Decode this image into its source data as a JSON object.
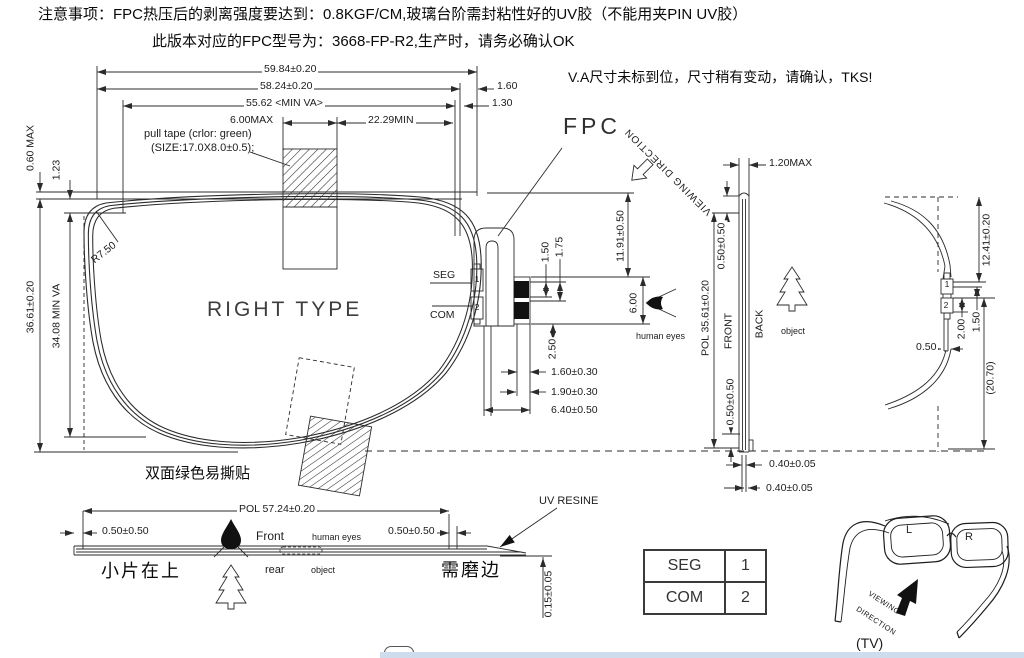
{
  "colors": {
    "line": "#2b2b2b",
    "taskbar_strip": "#cfdceb",
    "pad_fill": "#111111"
  },
  "notes": {
    "line1": "注意事项：FPC热压后的剥离强度要达到：0.8KGF/CM,玻璃台阶需封粘性好的UV胶（不能用夹PIN UV胶）",
    "line2": "此版本对应的FPC型号为：3668-FP-R2,生产时，请务必确认OK",
    "va_note": "V.A尺寸未标到位，尺寸稍有变动，请确认，TKS!"
  },
  "front_view": {
    "title": "RIGHT TYPE",
    "dim_width_outer": "59.84±0.20",
    "dim_width_pol": "58.24±0.20",
    "dim_right_1": "1.60",
    "dim_width_va": "55.62 <MIN VA>",
    "dim_right_2": "1.30",
    "dim_tape_offset": "6.00MAX",
    "dim_tape_to_edge": "22.29MIN",
    "dim_height_left_1": "0.60 MAX",
    "dim_height_left_2": "1.23",
    "dim_height_outer": "36.61±0.20",
    "dim_height_va": "34.08 MIN VA",
    "corner_radius": "R7.50",
    "pull_tape_note1": "pull tape (crlor: green)",
    "pull_tape_note2": "(SIZE:17.0X8.0±0.5);",
    "seg_label": "SEG",
    "com_label": "COM",
    "pad1": "1",
    "pad2": "2",
    "sticker_note": "双面绿色易撕贴"
  },
  "fpc": {
    "label": "FPC",
    "dim_pad_w1": "1.50",
    "dim_pad_w2": "1.75",
    "dim_length": "11.91±0.50",
    "dim_pad_h": "6.00",
    "dim_tail": "2.50",
    "dim_b1": "1.60±0.30",
    "dim_b2": "1.90±0.30",
    "dim_b3": "6.40±0.50"
  },
  "side_view": {
    "viewing_direction": "VIEWING DIRECTION",
    "dim_thickness": "1.20MAX",
    "dim_top_gap": "0.50±0.50",
    "dim_pol_height": "POL 35.61±0.20",
    "front_label": "FRONT",
    "back_label": "BACK",
    "human_eyes": "human eyes",
    "object_label": "object",
    "dim_bottom_gap": "0.50±0.50",
    "dim_glass_1": "0.40±0.05",
    "dim_glass_2": "0.40±0.05"
  },
  "profile_view": {
    "dim_top": "12.41±0.20",
    "pad1": "1",
    "pad2": "2",
    "dim_pad_gap": "1.50",
    "dim_pad_pitch": "2.00",
    "dim_tail_w": "0.50",
    "dim_total": "(20.70)"
  },
  "bottom_view": {
    "dim_pol_width": "POL 57.24±0.20",
    "dim_left": "0.50±0.50",
    "dim_right": "0.50±0.50",
    "front_label": "Front",
    "human_eyes": "human eyes",
    "rear_label": "rear",
    "object_label": "object",
    "uv_resin": "UV RESINE",
    "dim_thickness": "0.15±0.05",
    "note_left": "小片在上",
    "note_right": "需磨边"
  },
  "pin_table": {
    "rows": [
      {
        "label": "SEG",
        "value": "1"
      },
      {
        "label": "COM",
        "value": "2"
      }
    ]
  },
  "glasses": {
    "left_lens": "L",
    "right_lens": "R",
    "viewing_word1": "VIEWING",
    "viewing_word2": "DIRECTION",
    "tv_label": "(TV)"
  }
}
